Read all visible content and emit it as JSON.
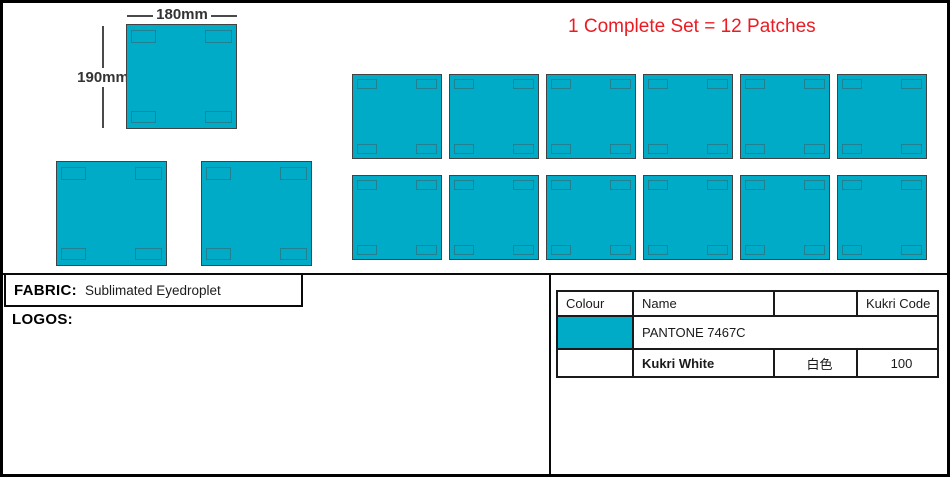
{
  "colors": {
    "patch_fill": "#00abc7",
    "note_red": "#ec1b23"
  },
  "annotations": {
    "width_label": "180mm",
    "height_label": "190mm",
    "note": "1 Complete Set = 12 Patches"
  },
  "patch_grid": {
    "rows": 2,
    "cols": 6,
    "total": 12
  },
  "fabric": {
    "label": "FABRIC:",
    "value": "Sublimated Eyedroplet"
  },
  "logos_label": "LOGOS:",
  "color_table": {
    "headers": [
      "Colour",
      "Name",
      "",
      "Kukri Code"
    ],
    "rows": [
      {
        "swatch_color": "#00abc7",
        "name": "PANTONE 7467C",
        "alt_name": "",
        "code": ""
      },
      {
        "swatch_color": "",
        "name": "Kukri White",
        "alt_name": "白色",
        "code": "100"
      }
    ]
  }
}
